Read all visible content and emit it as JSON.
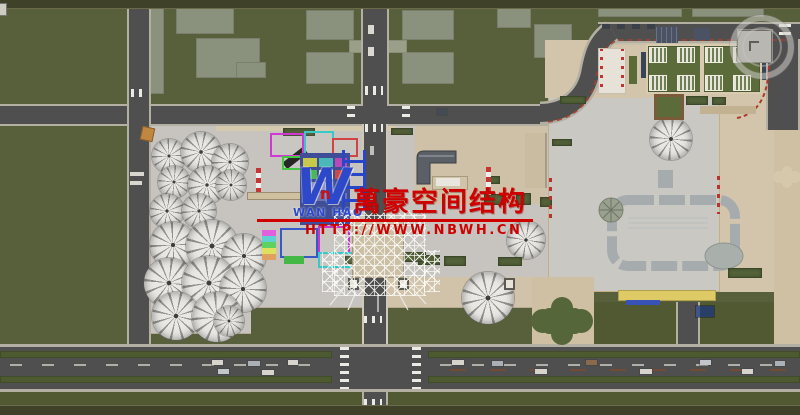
{
  "watermark": {
    "logo_letter": "W",
    "logo_accent_letter": "n",
    "logo_subtext": "WAN HAO",
    "title": "萬豪空间结构",
    "url": "HTTP://WWW.NBWH.CN"
  },
  "icons": {
    "nav_widget": "orbit-ring-icon",
    "corner_fragment": "window-corner-icon"
  },
  "palette": {
    "grass": "#57603a",
    "grass_dark": "#505931",
    "frame_strip": "#3f4129",
    "road_asphalt": "#4f4f4f",
    "road_edge": "#b3b0a3",
    "plaza_gray": "#c7c4bf",
    "plaza_beige": "#d2c5ab",
    "building_gray": "#8a917c",
    "hedge_green": "#55633a",
    "watermark_red": "#ce0000",
    "logo_blue": "#2d49c9",
    "canopy_yellow": "#decb66"
  }
}
